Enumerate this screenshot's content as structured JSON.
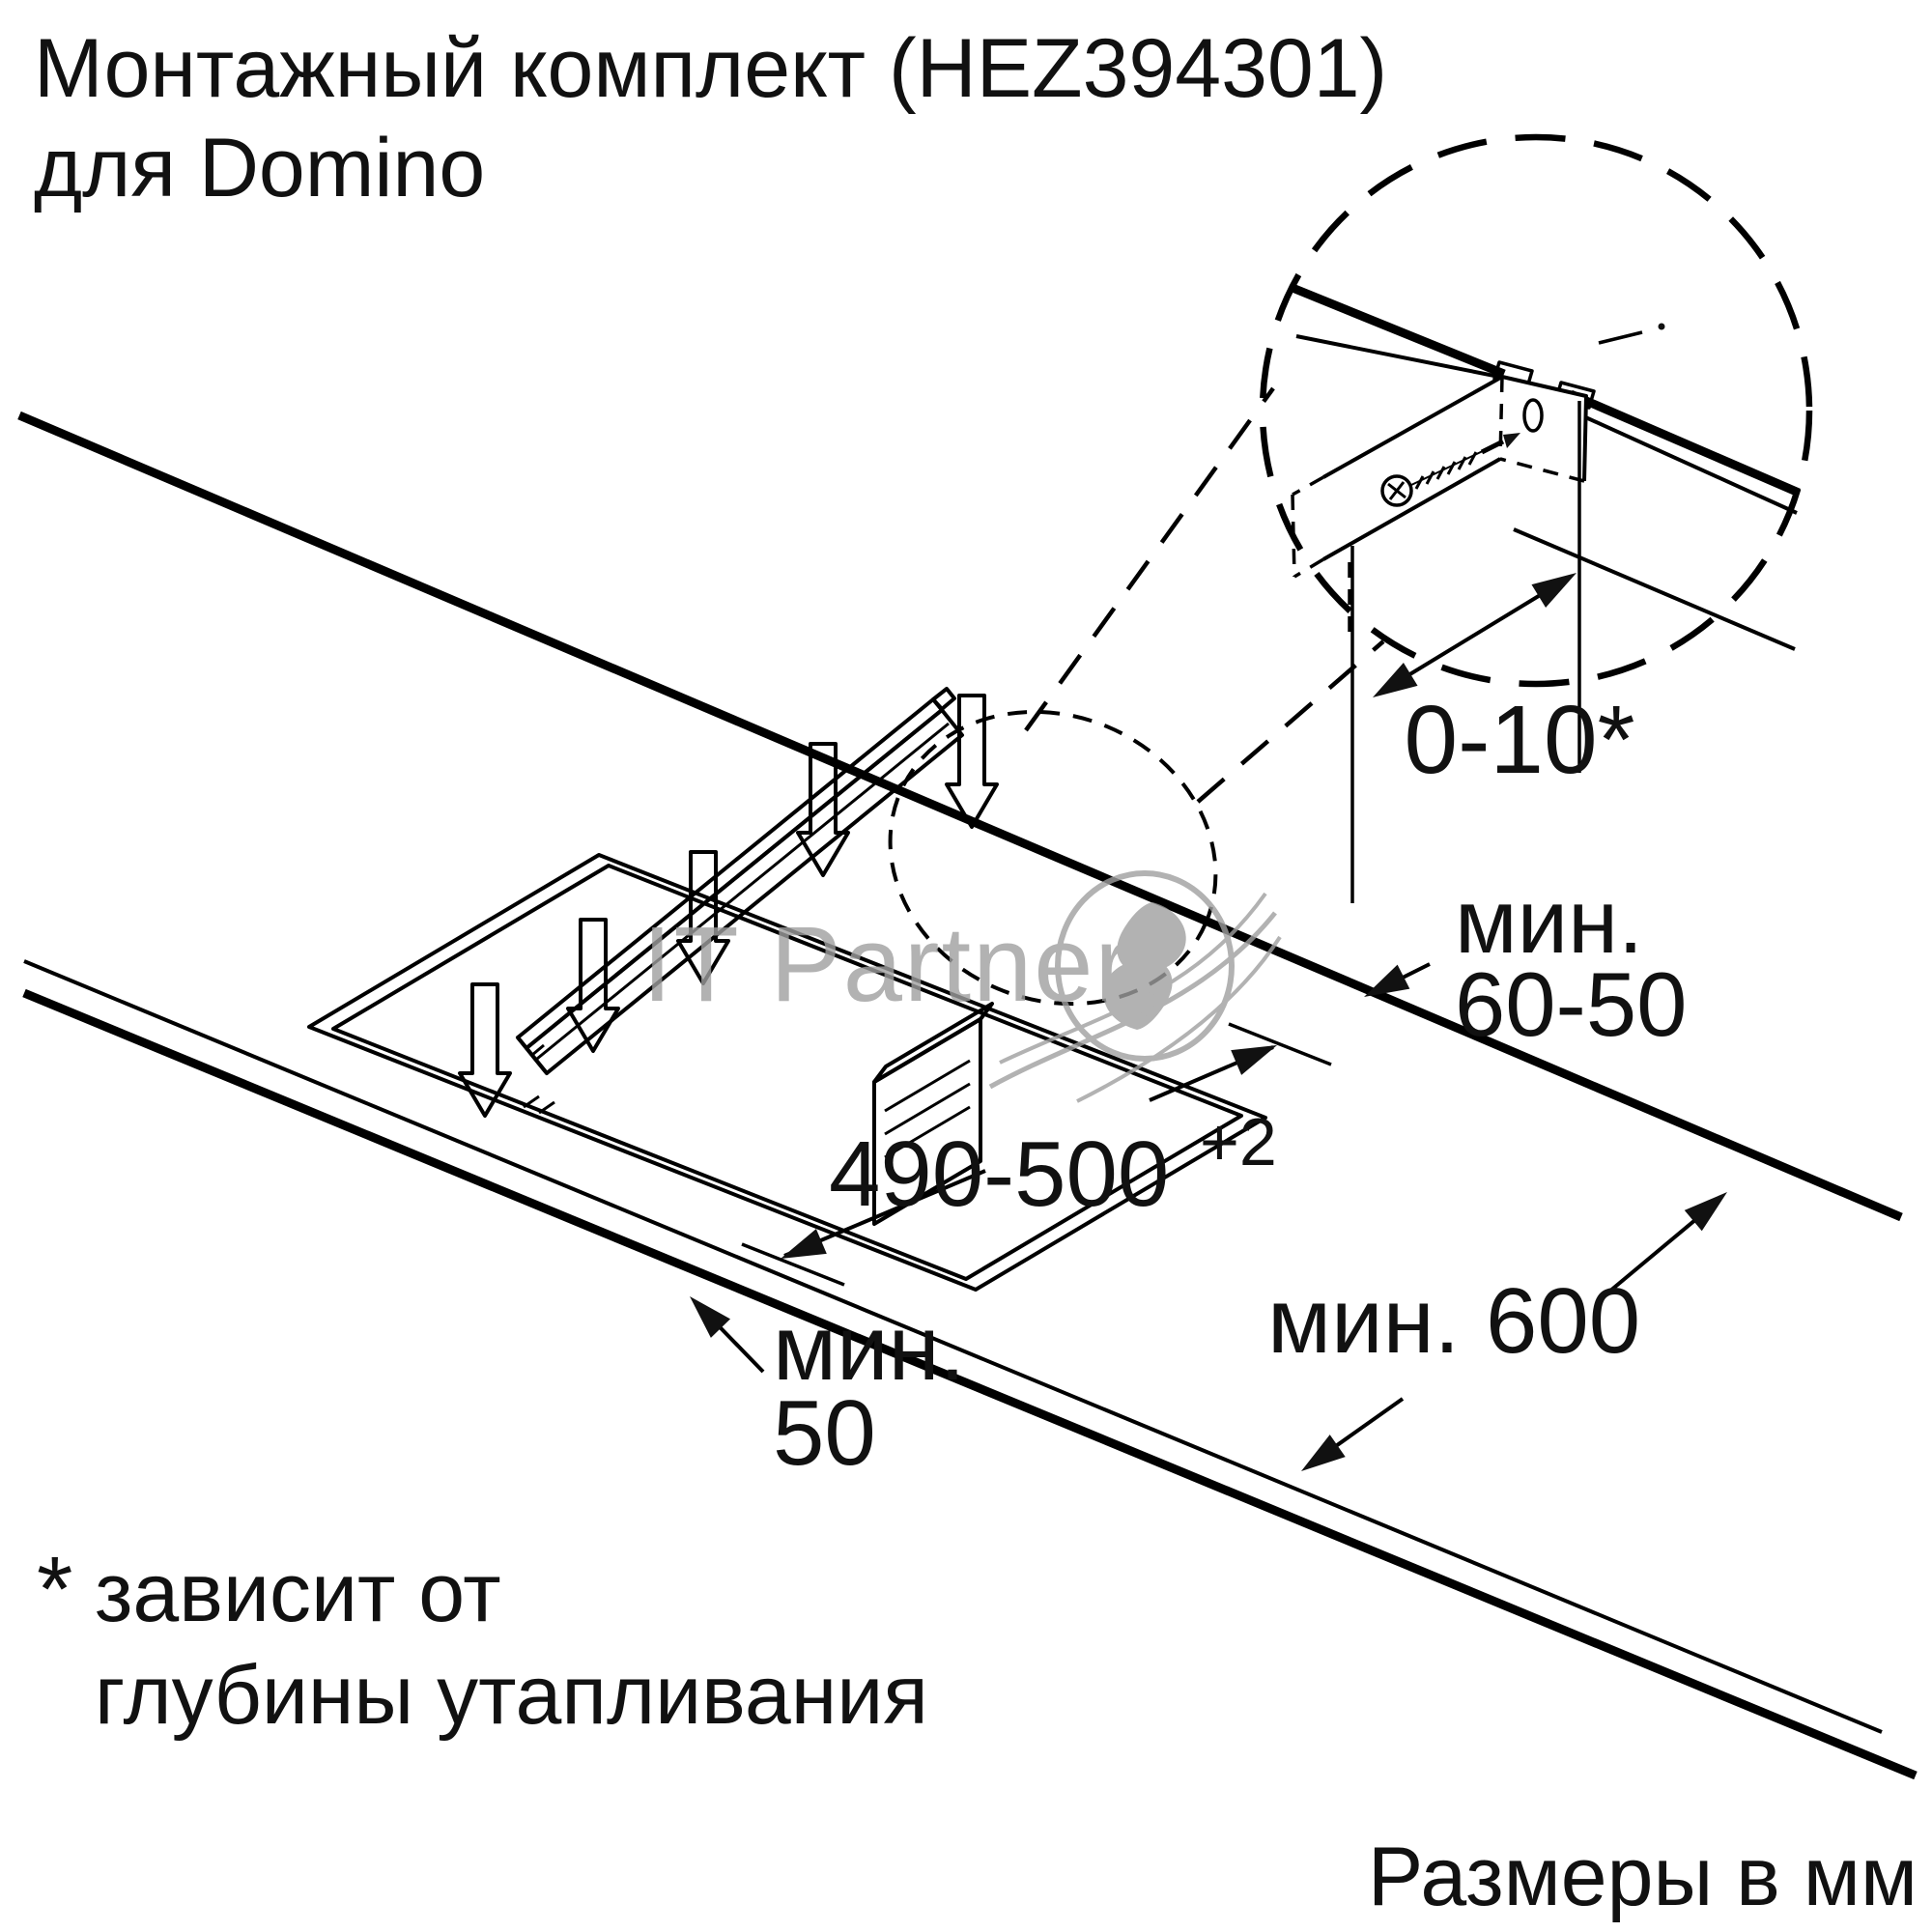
{
  "canvas": {
    "background": "#ffffff",
    "line_color": "#000000",
    "text_color": "#111111",
    "watermark_color": "#9f9f9f"
  },
  "title": {
    "line1": "Монтажный комплект (HEZ394301)",
    "line2": "для Domino"
  },
  "detail_view": {
    "offset_dimension": "0-10*"
  },
  "dimensions": {
    "back_strip_line1": "мин.",
    "back_strip_line2": "60-50",
    "cutout_width_value": "490-500",
    "cutout_width_tolerance": "+2",
    "front_strip_line1": "мин.",
    "front_strip_line2": "50",
    "worktop_depth": "мин. 600"
  },
  "footnote": {
    "marker": "*",
    "line1": "зависит от",
    "line2": "глубины утапливания"
  },
  "units_note": "Размеры в мм",
  "watermark": {
    "text": "IT Partner"
  },
  "icons": {
    "down_arrow": "hollow arrow pointing down (insertion direction)",
    "screw": "countersunk phillips screw",
    "detail_circle": "dashed magnification circle",
    "swirl_logo": "gray watermark swirl"
  }
}
